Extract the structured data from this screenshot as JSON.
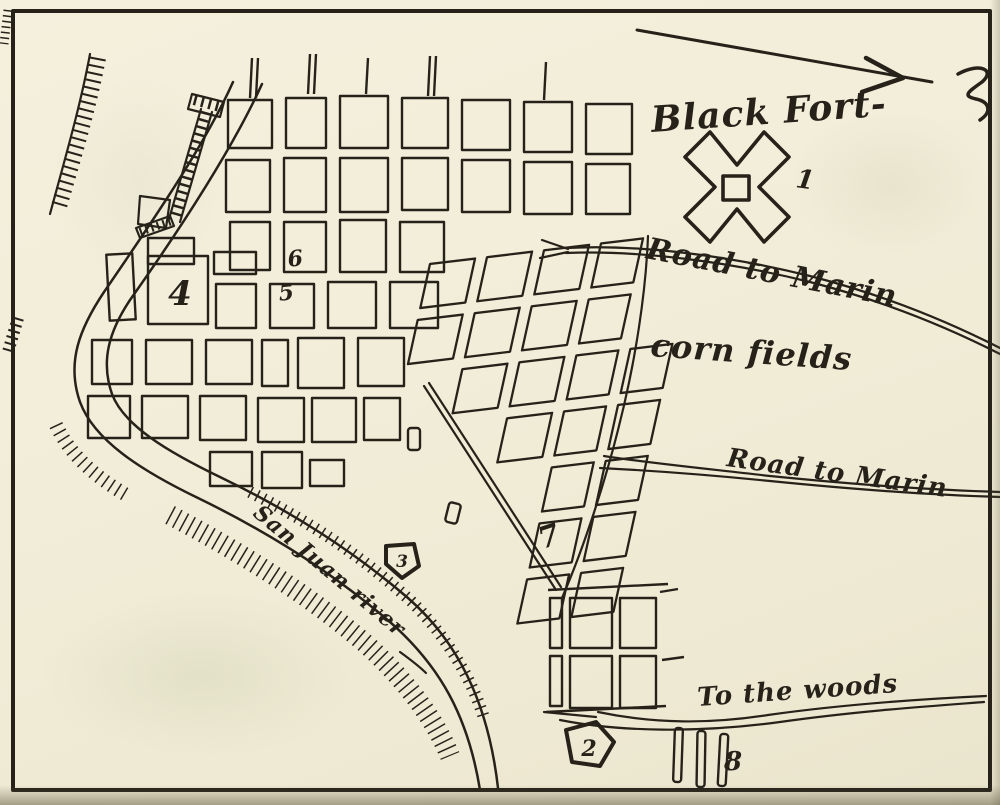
{
  "labels": {
    "black_fort": "Black Fort-",
    "road_to_marin_upper": "Road to Marin",
    "corn_fields": "corn fields",
    "road_to_marin_lower": "Road to Marin",
    "to_the_woods": "To the woods",
    "river": "San Juan river"
  },
  "markers": {
    "m1": "1",
    "m2": "2",
    "m3": "3",
    "m4": "4",
    "m5": "5",
    "m6": "6",
    "m7": "7",
    "m8": "8"
  },
  "colors": {
    "paper": "#f2eeda",
    "ink": "#26221a"
  }
}
